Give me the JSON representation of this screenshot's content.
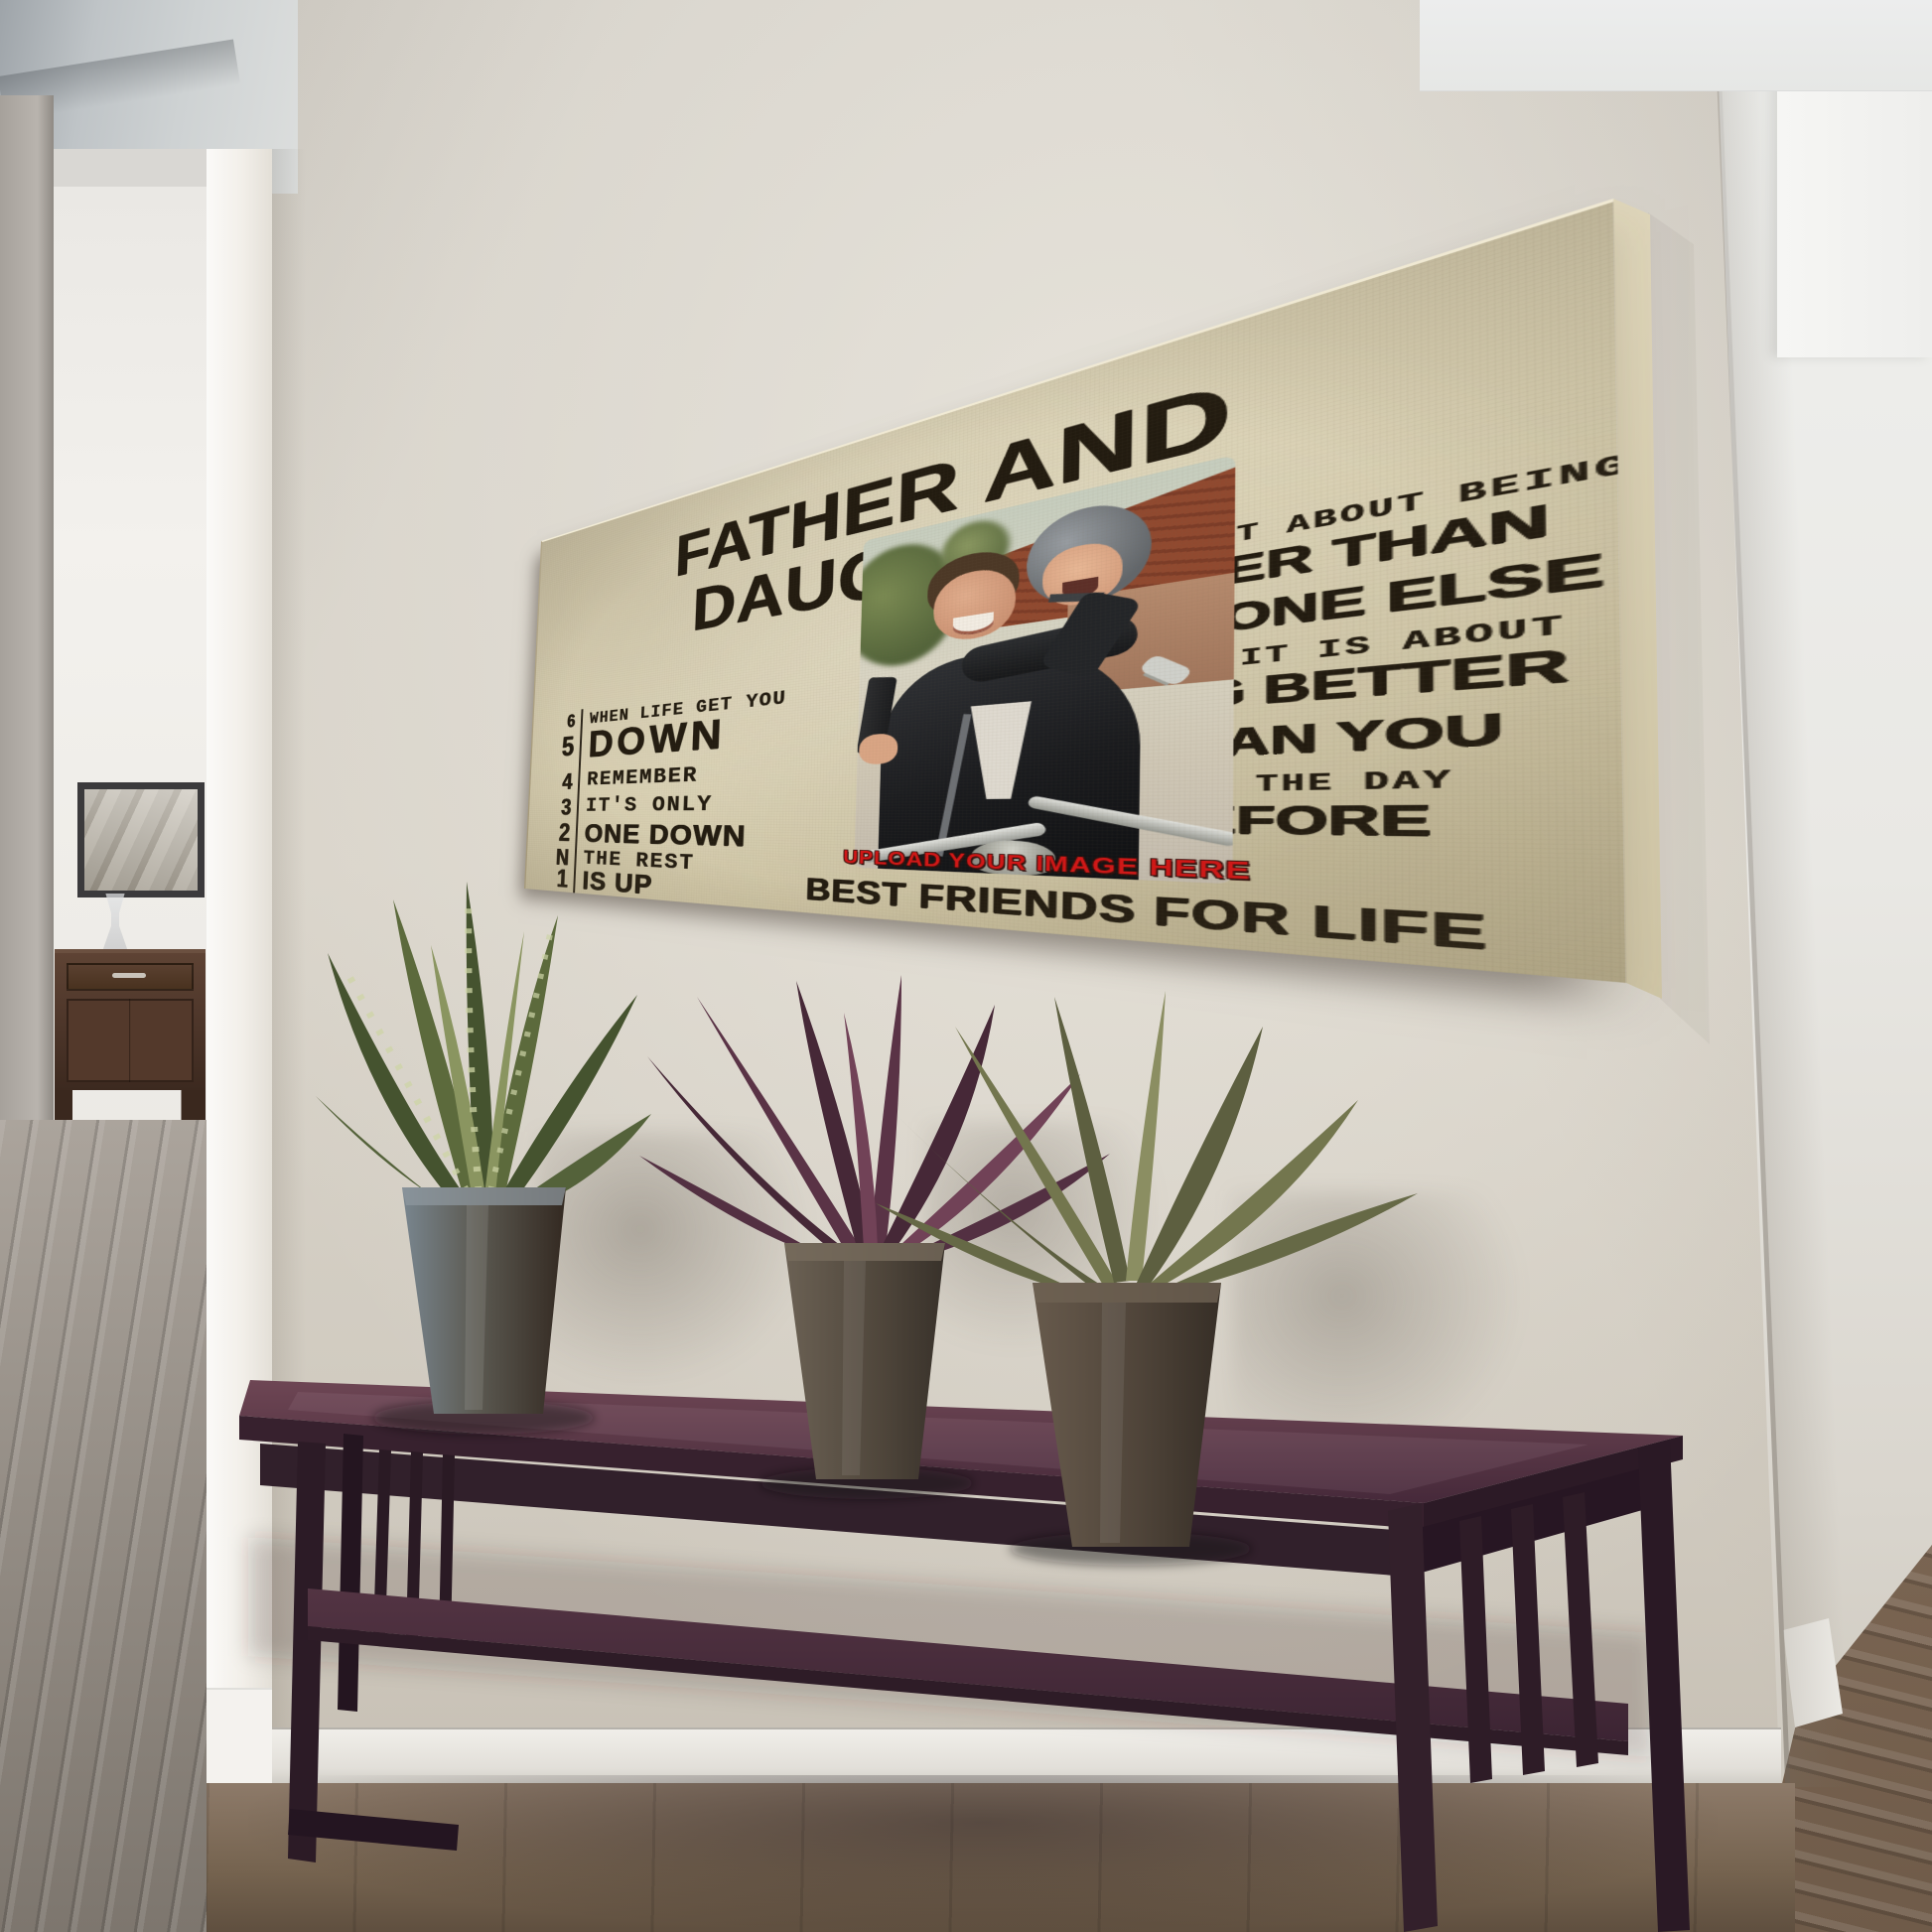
{
  "artwork": {
    "title": "FATHER AND DAUGHTER",
    "gear_shift": {
      "lines": [
        {
          "gear": "6",
          "text": "WHEN LIFE GET YOU"
        },
        {
          "gear": "5",
          "text": "DOWN"
        },
        {
          "gear": "4",
          "text": "REMEMBER"
        },
        {
          "gear": "3",
          "text": "IT'S ONLY"
        },
        {
          "gear": "2",
          "text": "ONE DOWN"
        },
        {
          "gear": "N",
          "text": "THE REST"
        },
        {
          "gear": "1",
          "text": "IS UP"
        }
      ]
    },
    "upload_label": "UPLOAD YOUR IMAGE HERE",
    "footer_line": "BEST FRIENDS FOR LIFE",
    "quote_lines": [
      "IT IS NOT ABOUT BEING",
      "BETTER THAN",
      "SOMEONE ELSE",
      "IT IS ABOUT",
      "BEING BETTER",
      "THAN YOU",
      "WERE THE DAY",
      "BEFORE"
    ],
    "colors": {
      "canvas_background": "#d6cdaf",
      "ink_black": "#221b10",
      "accent_red": "#d31616",
      "table_wood": "#42293a",
      "wall_greige": "#d9d4ca"
    }
  }
}
